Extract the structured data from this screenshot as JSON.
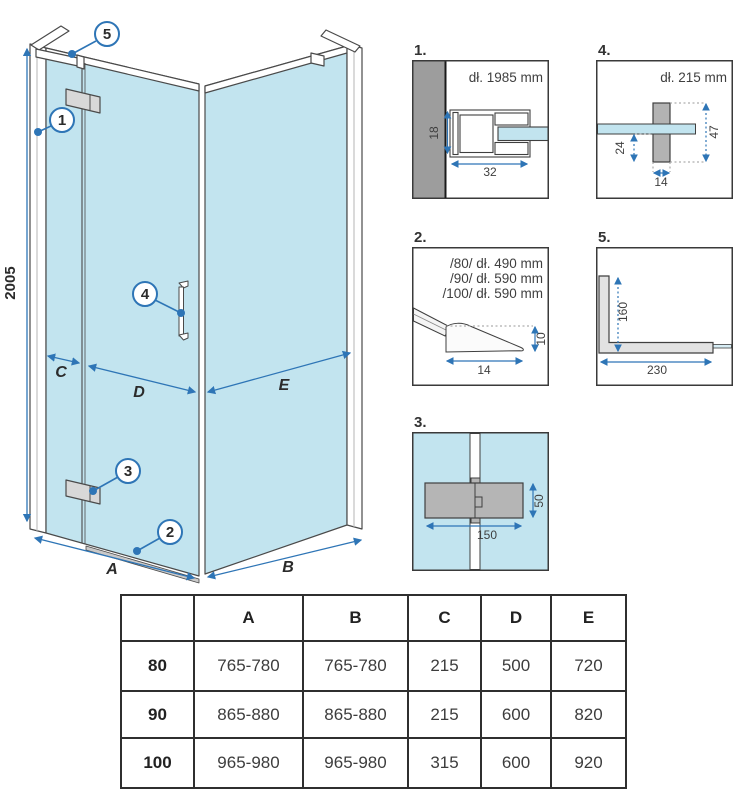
{
  "colors": {
    "accent_blue": "#2e75b6",
    "glass_blue": "#c2e4ef",
    "outline_gray": "#4a4a4a",
    "wall_gray": "#9d9d9d",
    "part_gray": "#b5b5b5"
  },
  "main": {
    "height_dim": "2005",
    "labels": {
      "A": "A",
      "B": "B",
      "C": "C",
      "D": "D",
      "E": "E"
    },
    "callouts": {
      "n1": "1",
      "n2": "2",
      "n3": "3",
      "n4": "4",
      "n5": "5"
    }
  },
  "details": {
    "d1": {
      "label": "1.",
      "title": "dł. 1985 mm",
      "dim_h": "18",
      "dim_w": "32"
    },
    "d2": {
      "label": "2.",
      "line1": "/80/ dł. 490 mm",
      "line2": "/90/ dł. 590 mm",
      "line3": "/100/ dł. 590 mm",
      "dim_h": "10",
      "dim_w": "14"
    },
    "d3": {
      "label": "3.",
      "dim_w": "150",
      "dim_h": "50"
    },
    "d4": {
      "label": "4.",
      "title": "dł. 215 mm",
      "dim_a": "24",
      "dim_b": "47",
      "dim_w": "14"
    },
    "d5": {
      "label": "5.",
      "dim_v": "160",
      "dim_w": "230"
    }
  },
  "table": {
    "headers": [
      "",
      "A",
      "B",
      "C",
      "D",
      "E"
    ],
    "rows": [
      {
        "size": "80",
        "values": [
          "765-780",
          "765-780",
          "215",
          "500",
          "720"
        ]
      },
      {
        "size": "90",
        "values": [
          "865-880",
          "865-880",
          "215",
          "600",
          "820"
        ]
      },
      {
        "size": "100",
        "values": [
          "965-980",
          "965-980",
          "315",
          "600",
          "920"
        ]
      }
    ]
  }
}
